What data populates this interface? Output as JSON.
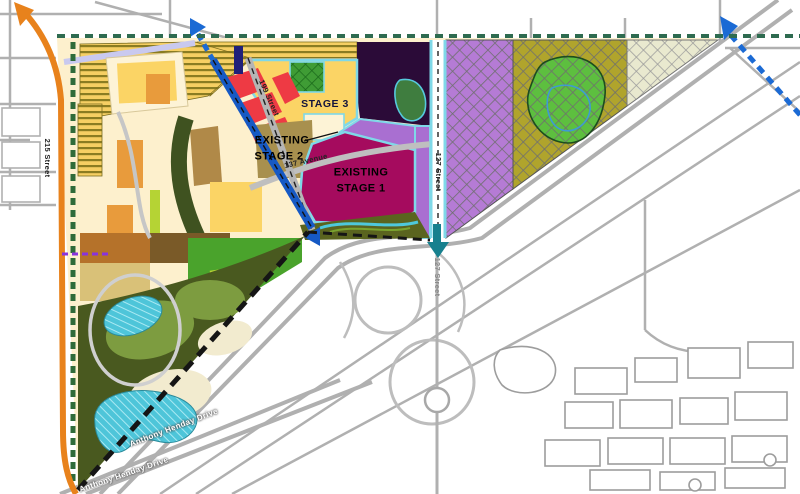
{
  "map": {
    "kind": "area-structure-plan-map",
    "stage_labels": {
      "stage3": "STAGE 3",
      "existing_stage2_line1": "EXISTING",
      "existing_stage2_line2": "STAGE 2",
      "existing_stage1_line1": "EXISTING",
      "existing_stage1_line2": "STAGE 1"
    },
    "street_labels": {
      "street_199": "199 Street",
      "street_127_north": "127 Street",
      "street_127_south": "127 Street",
      "avenue_137": "137 Avenue",
      "street_215": "215 Street",
      "henday_upper": "Anthony Henday Drive",
      "henday_lower": "Anthony Henday Drive"
    },
    "icons": {
      "future_corridor_arrow_ne": "blue-dashed-arrow-northeast",
      "future_corridor_arrow_sw": "blue-arrow-southwest",
      "future_corridor_arrow_corner": "blue-dashed-arrow-northeast",
      "flow_arrow_south": "teal-arrow-south",
      "arterial_arrow_nw": "orange-arrow-northwest"
    },
    "colors": {
      "stage1_fill": "#a50b5e",
      "stage2_fill": "#ee3a44",
      "stage3_fill": "#fbd465",
      "future_purple_hatch": "#b57bd5",
      "future_olive_hatch": "#b0a42c",
      "future_cream_hatch": "#e9e9cf",
      "corridor_blue": "#1659c4",
      "arterial_orange": "#e8821c",
      "boundary_green": "#2e6b50",
      "arrow_teal": "#17808e",
      "pond_cyan": "#4ec5d9",
      "natural_green": "#49591f",
      "aqua_border": "#7fd8e8"
    }
  }
}
